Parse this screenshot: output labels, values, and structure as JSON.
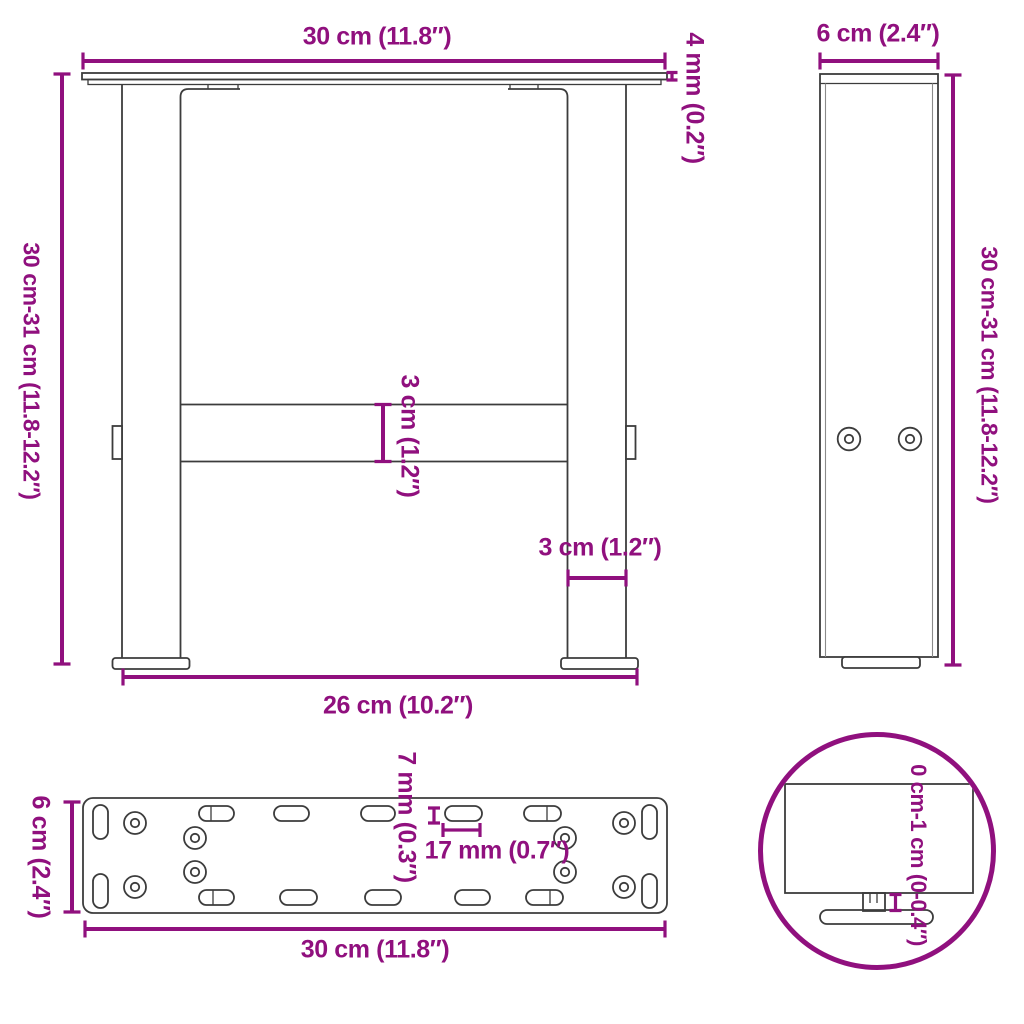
{
  "colors": {
    "dimension_accent": "#90107E",
    "drawing_line": "#3c3c3c",
    "background": "#ffffff"
  },
  "views": {
    "front_view": {
      "dim_width_top": "30 cm (11.8″)",
      "dim_plate_thickness": "4 mm (0.2″)",
      "dim_height_range": "30 cm-31 cm (11.8-12.2″)",
      "dim_crossbar_height": "3 cm (1.2″)",
      "dim_leg_width": "3 cm (1.2″)",
      "dim_feet_span": "26 cm (10.2″)"
    },
    "side_view": {
      "dim_depth": "6 cm (2.4″)",
      "dim_height_range": "30 cm-31 cm (11.8-12.2″)"
    },
    "plate_view": {
      "dim_depth": "6 cm (2.4″)",
      "dim_hole_width": "7 mm (0.3″)",
      "dim_slot_length": "17 mm (0.7″)",
      "dim_length": "30 cm (11.8″)"
    },
    "detail_view": {
      "dim_adjustable_range": "0 cm-1 cm (0-0.4″)"
    }
  }
}
